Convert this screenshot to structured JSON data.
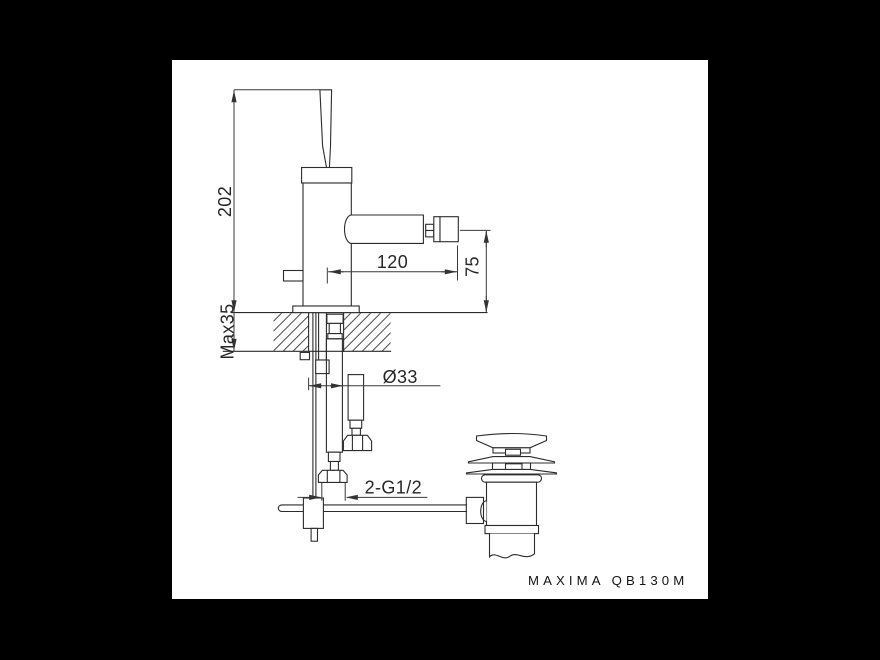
{
  "colors": {
    "background": "#000000",
    "sheet": "#ffffff",
    "line": "#2c2c2c"
  },
  "dimensions": {
    "total_height": "202",
    "spout_reach": "120",
    "spout_height_above_deck": "75",
    "max_deck_thickness": "Max35",
    "mounting_hole_diameter": "Ø33",
    "supply_connections": "2-G1/2"
  },
  "model_label": "MAXIMA QB130M"
}
